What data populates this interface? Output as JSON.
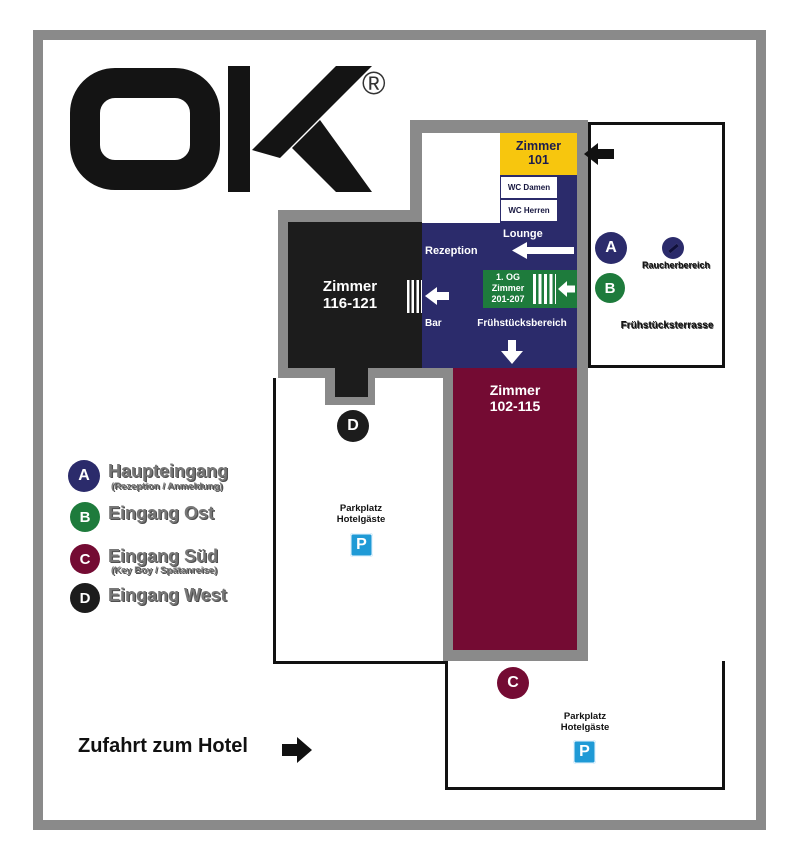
{
  "logo": {
    "mark": "OK",
    "tagline": "DAS BUSINESSHOTEL",
    "registered": "®"
  },
  "plan": {
    "rooms": {
      "zimmer101": {
        "line1": "Zimmer",
        "line2": "101"
      },
      "wc_damen": "WC Damen",
      "wc_herren": "WC Herren",
      "lounge": "Lounge",
      "rezeption": "Rezeption",
      "bar": "Bar",
      "fruehstuecksbereich": "Frühstücksbereich",
      "og_sign": {
        "line1": "1. OG",
        "line2": "Zimmer",
        "line3": "201-207"
      },
      "zimmer116": {
        "line1": "Zimmer",
        "line2": "116-121"
      },
      "zimmer102": {
        "line1": "Zimmer",
        "line2": "102-115"
      }
    },
    "outdoor": {
      "raucherbereich": "Raucherbereich",
      "fruehstuecksterrasse": "Frühstücksterrasse",
      "parkplatz_west": {
        "line1": "Parkplatz",
        "line2": "Hotelgäste"
      },
      "parkplatz_sued": {
        "line1": "Parkplatz",
        "line2": "Hotelgäste"
      },
      "parking_symbol": "P"
    },
    "markers": {
      "a": "A",
      "b": "B",
      "c": "C",
      "d": "D"
    }
  },
  "legend": {
    "items": [
      {
        "marker": "A",
        "label": "Haupteingang",
        "sub": "(Rezeption / Anmeldung)",
        "color": "#2b2b6b"
      },
      {
        "marker": "B",
        "label": "Eingang Ost",
        "sub": "",
        "color": "#1e7b3c"
      },
      {
        "marker": "C",
        "label": "Eingang Süd",
        "sub": "(Key Boy / Spätanreise)",
        "color": "#740b33"
      },
      {
        "marker": "D",
        "label": "Eingang West",
        "sub": "",
        "color": "#1c1c1c"
      }
    ]
  },
  "footer": {
    "zufahrt": "Zufahrt zum Hotel"
  },
  "colors": {
    "navy": "#2b2b6b",
    "yellow": "#f7c60e",
    "green": "#1e7b3c",
    "maroon": "#740b33",
    "black": "#1c1c1c",
    "frame_gray": "#8a8a8a",
    "parking_blue": "#1f9ad6"
  }
}
